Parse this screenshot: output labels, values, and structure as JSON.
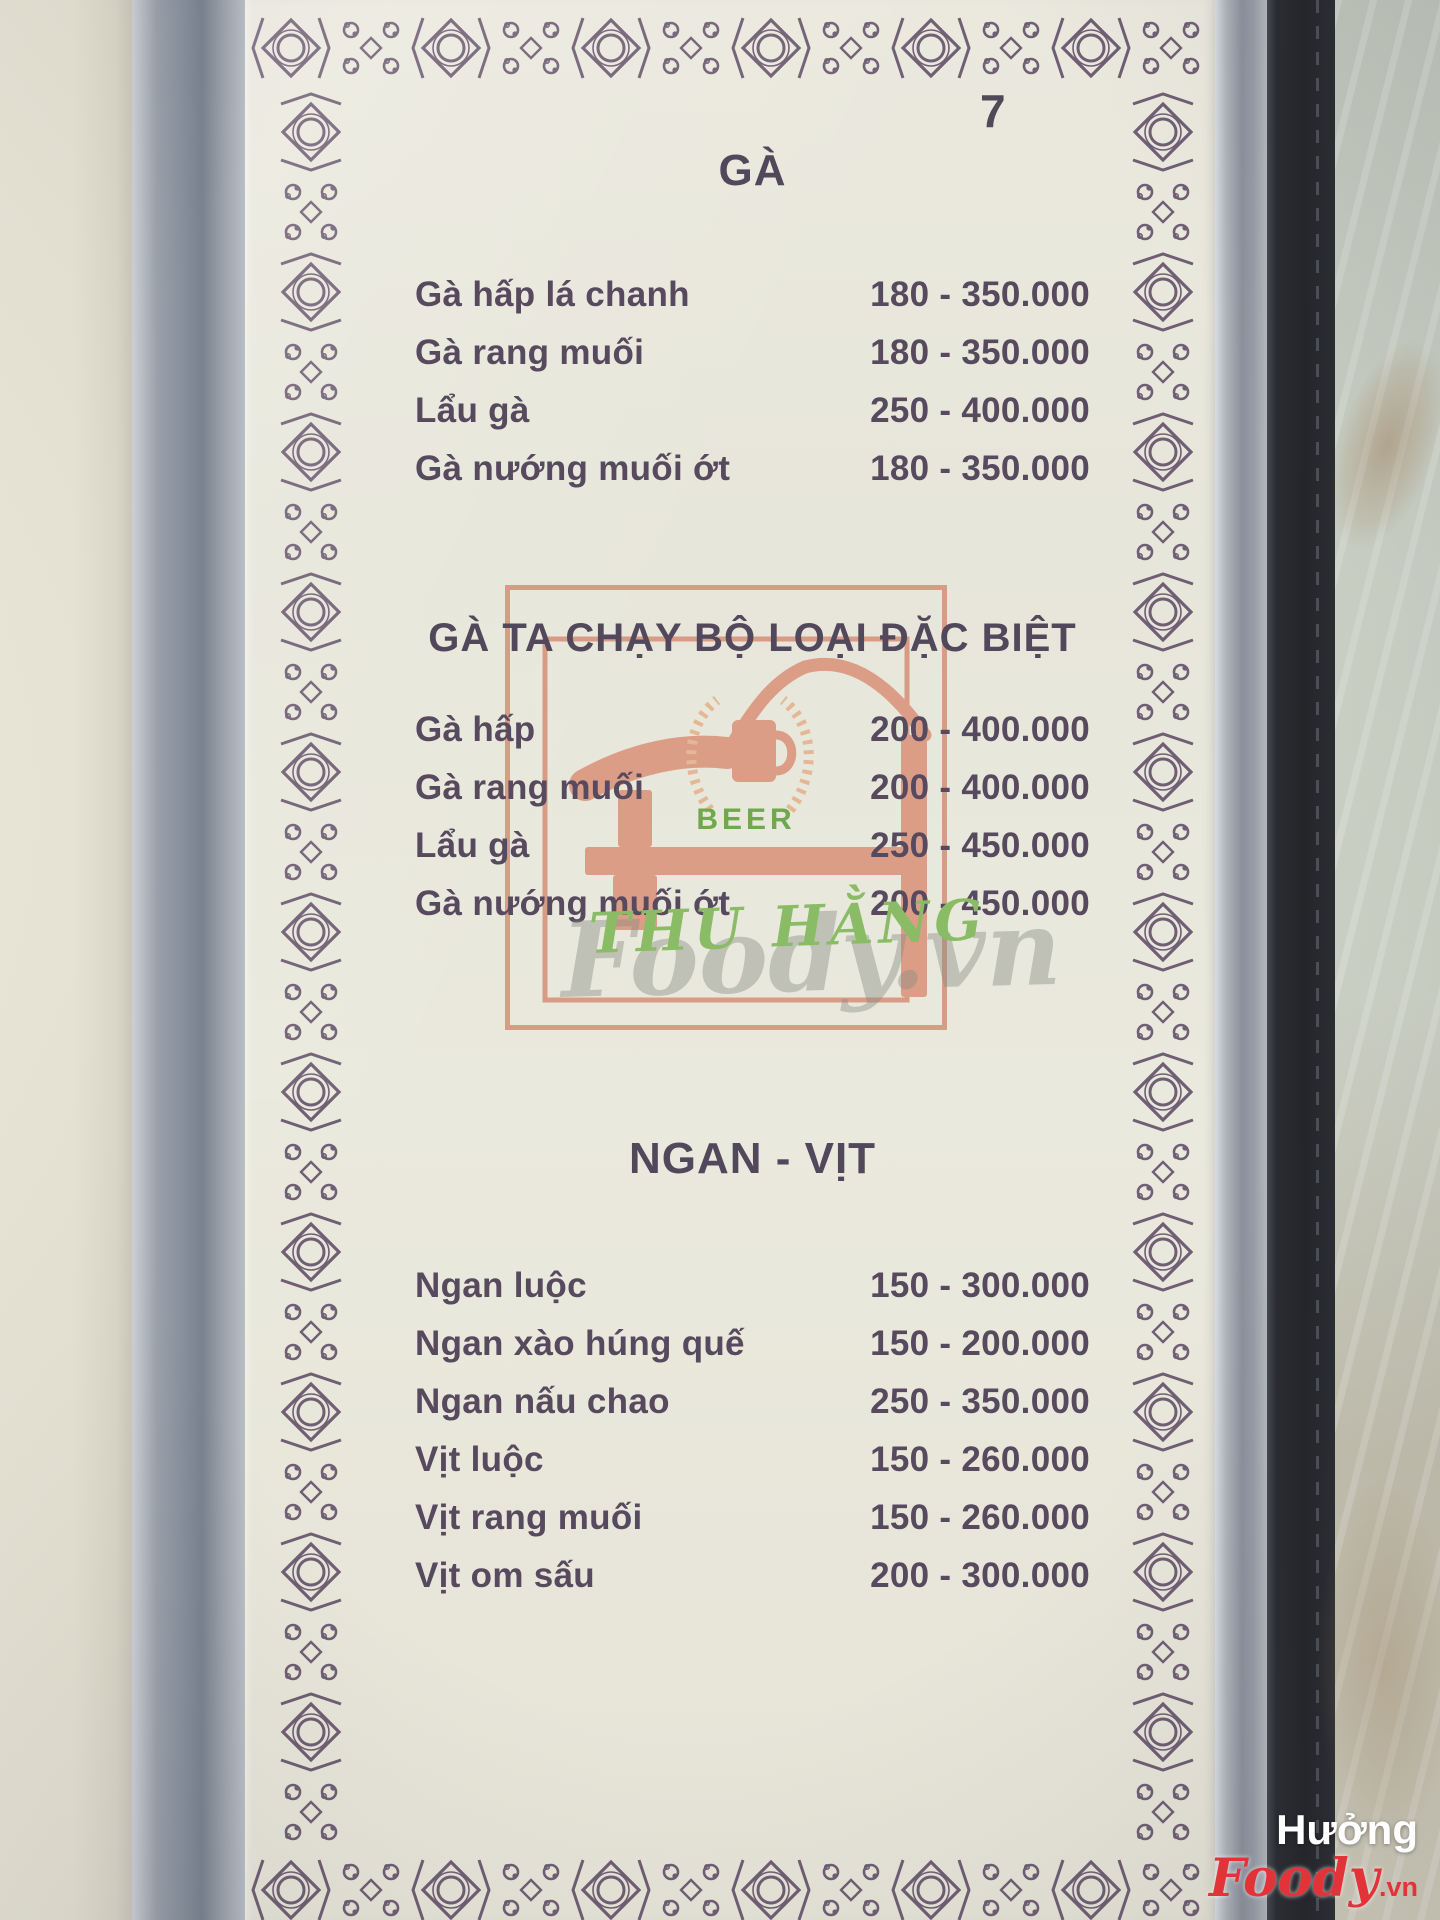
{
  "page": {
    "number": "7"
  },
  "menu": {
    "sections": [
      {
        "title": "GÀ",
        "items": [
          {
            "name": "Gà hấp lá chanh",
            "price": "180 - 350.000"
          },
          {
            "name": "Gà rang muối",
            "price": "180 - 350.000"
          },
          {
            "name": "Lẩu gà",
            "price": "250 - 400.000"
          },
          {
            "name": "Gà nướng muối ớt",
            "price": "180 - 350.000"
          }
        ]
      },
      {
        "title": "GÀ TA CHẠY BỘ LOẠI ĐẶC BIỆT",
        "items": [
          {
            "name": "Gà hấp",
            "price": "200 - 400.000"
          },
          {
            "name": "Gà rang muối",
            "price": "200 - 400.000"
          },
          {
            "name": "Lẩu gà",
            "price": "250 - 450.000"
          },
          {
            "name": "Gà nướng muối ớt",
            "price": "200 - 450.000"
          }
        ]
      },
      {
        "title": "NGAN - VỊT",
        "items": [
          {
            "name": "Ngan luộc",
            "price": "150 - 300.000"
          },
          {
            "name": "Ngan xào húng quế",
            "price": "150 - 200.000"
          },
          {
            "name": "Ngan nấu chao",
            "price": "250 - 350.000"
          },
          {
            "name": "Vịt luộc",
            "price": "150 - 260.000"
          },
          {
            "name": "Vịt rang muối",
            "price": "150 - 260.000"
          },
          {
            "name": "Vịt om sấu",
            "price": "200 - 300.000"
          }
        ]
      }
    ]
  },
  "logo": {
    "beer_label": "BEER",
    "restaurant_name": "THU HẰNG"
  },
  "watermarks": {
    "center_brand": "Foody.vn",
    "corner_user": "Hưởng",
    "corner_brand": "Foody",
    "corner_tld": ".vn"
  },
  "colors": {
    "ornament": "#5f4c66",
    "menu_text": "#57495e",
    "logo_frame": "#d68f78",
    "logo_fill": "#da9179",
    "wreath": "#e4b08a",
    "beer_green": "#6fa84e",
    "script_green": "#8abc66",
    "foody_red": "#e23438"
  }
}
